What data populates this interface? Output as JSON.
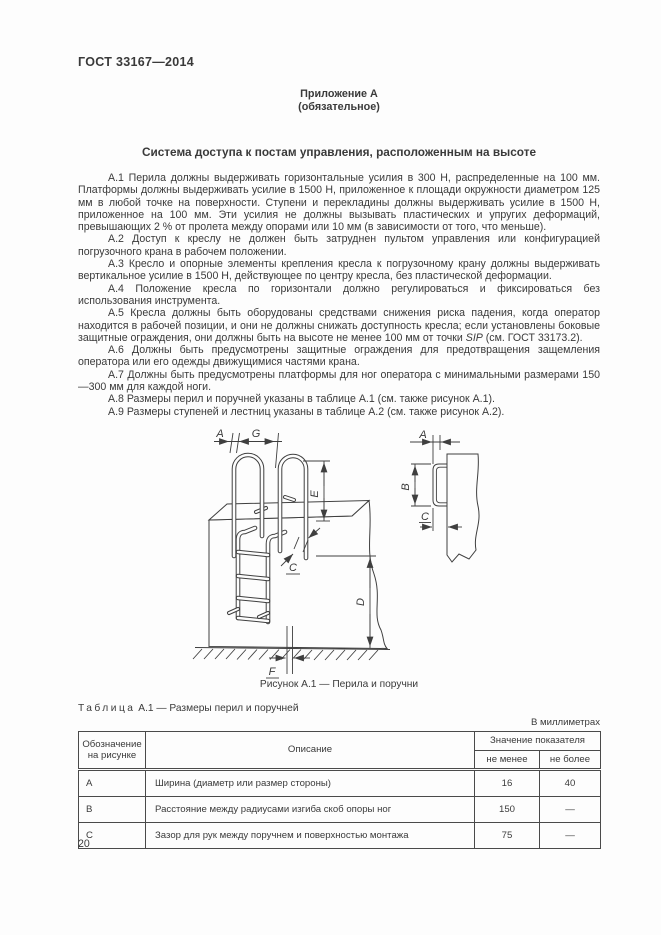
{
  "page": {
    "standard_code": "ГОСТ 33167—2014",
    "appendix_title": "Приложение А",
    "appendix_subtitle": "(обязательное)",
    "section_title": "Система доступа к постам управления, расположенным на высоте",
    "page_number": "20"
  },
  "ink_color": "#3a3a3a",
  "paragraphs": [
    {
      "text": "А.1 Перила должны выдерживать горизонтальные усилия в 300 Н, распределенные на 100 мм. Платформы должны выдерживать усилие в 1500 Н, приложенное к площади окружности диаметром 125 мм в любой точке на поверхности. Ступени и перекладины должны выдерживать усилие в 1500 Н, приложенное на 100 мм. Эти усилия не должны вызывать пластических и упругих деформаций, превышающих 2 % от пролета между опорами или 10 мм (в зависимости от того, что меньше)."
    },
    {
      "text": "А.2 Доступ к креслу не должен быть затруднен пультом управления или конфигурацией погрузочного крана в рабочем положении."
    },
    {
      "text": "А.3 Кресло и опорные элементы крепления кресла к погрузочному крану должны выдерживать вертикальное усилие в 1500 Н, действующее по центру кресла, без пластической деформации."
    },
    {
      "text": "А.4 Положение кресла по горизонтали должно регулироваться и фиксироваться без использования инструмента."
    },
    {
      "part1": "А.5 Кресла должны быть оборудованы средствами снижения риска падения, когда оператор находится в рабочей позиции, и они не должны снижать доступность кресла; если установлены боковые защитные ограждения, они должны быть на высоте не менее 100 мм от точки ",
      "sip": "SIP",
      "part2": " (см. ГОСТ 33173.2)."
    },
    {
      "text": "А.6 Должны быть предусмотрены защитные ограждения для предотвращения защемления оператора или его одежды движущимися частями крана."
    },
    {
      "text": "А.7 Должны быть предусмотрены платформы для ног оператора с минимальными размерами 150—300 мм для каждой ноги."
    },
    {
      "text": "А.8 Размеры перил и поручней указаны в таблице А.1 (см. также рисунок А.1)."
    },
    {
      "text": "А.9 Размеры ступеней и лестниц указаны в таблице А.2 (см. также рисунок А.2)."
    }
  ],
  "figure": {
    "caption": "Рисунок А.1 — Перила и поручни",
    "labels": {
      "main": {
        "a": "A",
        "g": "G",
        "e": "E",
        "c": "C",
        "d": "D",
        "f": "F"
      },
      "side": {
        "a": "A",
        "b": "B",
        "c": "C"
      }
    }
  },
  "table": {
    "caption_label": "Таблица",
    "caption_text": " А.1 — Размеры перил и поручней",
    "units_note": "В миллиметрах",
    "columns": {
      "mark": "Обозначение на рисунке",
      "description": "Описание",
      "value": "Значение показателя",
      "min": "не менее",
      "max": "не более"
    },
    "rows": [
      {
        "mark": "A",
        "description": "Ширина (диаметр или размер стороны)",
        "min": "16",
        "max": "40"
      },
      {
        "mark": "B",
        "description": "Расстояние между радиусами изгиба скоб опоры ног",
        "min": "150",
        "max": "—"
      },
      {
        "mark": "C",
        "description": "Зазор для рук между поручнем и поверхностью монтажа",
        "min": "75",
        "max": "—"
      }
    ]
  }
}
